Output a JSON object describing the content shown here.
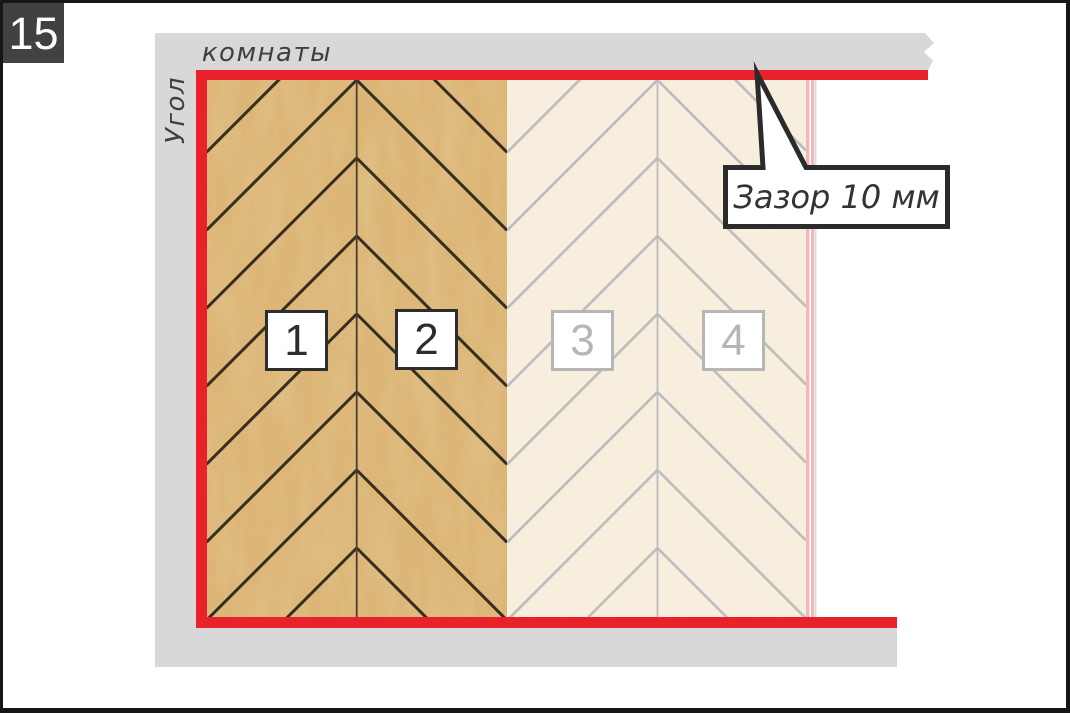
{
  "step_badge": {
    "number": "15"
  },
  "wall_labels": {
    "vertical": "Угол",
    "horizontal": "комнаты"
  },
  "callout": {
    "text": "Зазор 10 мм"
  },
  "panels": [
    {
      "label": "1",
      "state": "laid"
    },
    {
      "label": "2",
      "state": "laid"
    },
    {
      "label": "3",
      "state": "planned"
    },
    {
      "label": "4",
      "state": "planned"
    }
  ],
  "colors": {
    "badge_bg": "#414141",
    "badge_text": "#ffffff",
    "wall_gray": "#d8d8d8",
    "text_dark": "#3f3f3f",
    "gap_red": "#e8212b",
    "wood_base": "#dcb677",
    "wood_line": "#372d20",
    "wood_seam": "#4a3f2f",
    "pale_base": "#f7eedd",
    "pale_line": "#bbbcc0",
    "pale_edge_pink": "#f3b7ba",
    "label_laid": "#2d2d2d",
    "label_planned": "#b6b6b6",
    "callout_border": "#2b2b2b"
  }
}
